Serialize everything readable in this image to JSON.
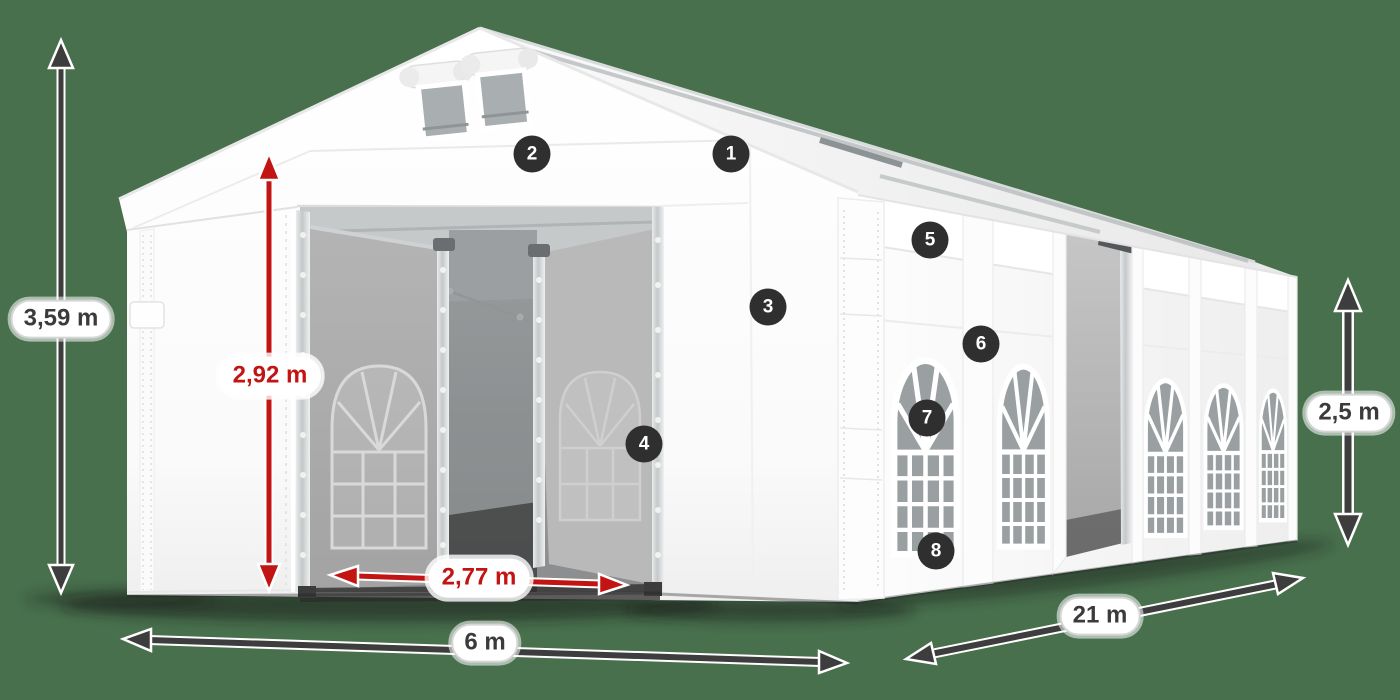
{
  "colors": {
    "background": "#48704D",
    "dimension_arrow": "#3d3d3d",
    "highlight_arrow": "#c31414",
    "pill_background": "#ffffff",
    "pill_border": "#d6d6d6",
    "pill_text": "#3b3b3b",
    "pill_text_highlight": "#c31414",
    "badge_background": "#2f2f2f",
    "badge_text": "#ffffff",
    "tent_fabric": "#f8f8f8",
    "window_glass": "#9aa0a2"
  },
  "dimensions": {
    "total_height": {
      "label": "3,59 m"
    },
    "entrance_height": {
      "label": "2,92 m"
    },
    "entrance_width": {
      "label": "2,77 m"
    },
    "width": {
      "label": "6 m"
    },
    "length": {
      "label": "21 m"
    },
    "side_height": {
      "label": "2,5 m"
    }
  },
  "callouts": {
    "items": [
      {
        "label": "1"
      },
      {
        "label": "2"
      },
      {
        "label": "3"
      },
      {
        "label": "4"
      },
      {
        "label": "5"
      },
      {
        "label": "6"
      },
      {
        "label": "7"
      },
      {
        "label": "8"
      }
    ]
  }
}
